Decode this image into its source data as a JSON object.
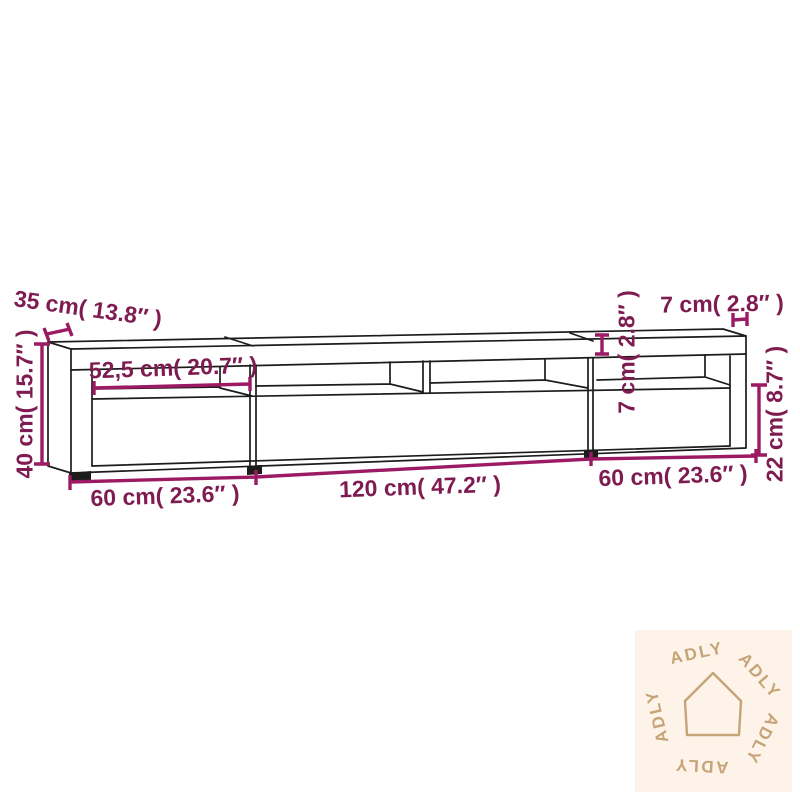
{
  "diagram": {
    "type": "furniture-dimension-drawing",
    "product": "TV cabinet with three sections and open shelves",
    "labels": {
      "depth": "35 cm( 13.8″ )",
      "height": "40 cm( 15.7″ )",
      "inner_shelf_width": "52,5 cm( 20.7″ )",
      "side_panel_width": "7 cm( 2.8″ )",
      "shelf_front_height": "7 cm( 2.8″ )",
      "lower_section_height": "22 cm( 8.7″ )",
      "left_section_width": "60 cm( 23.6″ )",
      "middle_section_width": "120 cm( 47.2″ )",
      "right_section_width": "60 cm( 23.6″ )"
    }
  },
  "watermark": {
    "brand": "ADLY",
    "icon": "house-outline-icon"
  },
  "colors": {
    "annotation_text": "#7e1c51",
    "annotation_line": "#9c1a63",
    "line_art": "#1c1c1c",
    "watermark_background": "#fdf3e9",
    "watermark_foreground": "#c6a477",
    "background": "#ffffff"
  }
}
